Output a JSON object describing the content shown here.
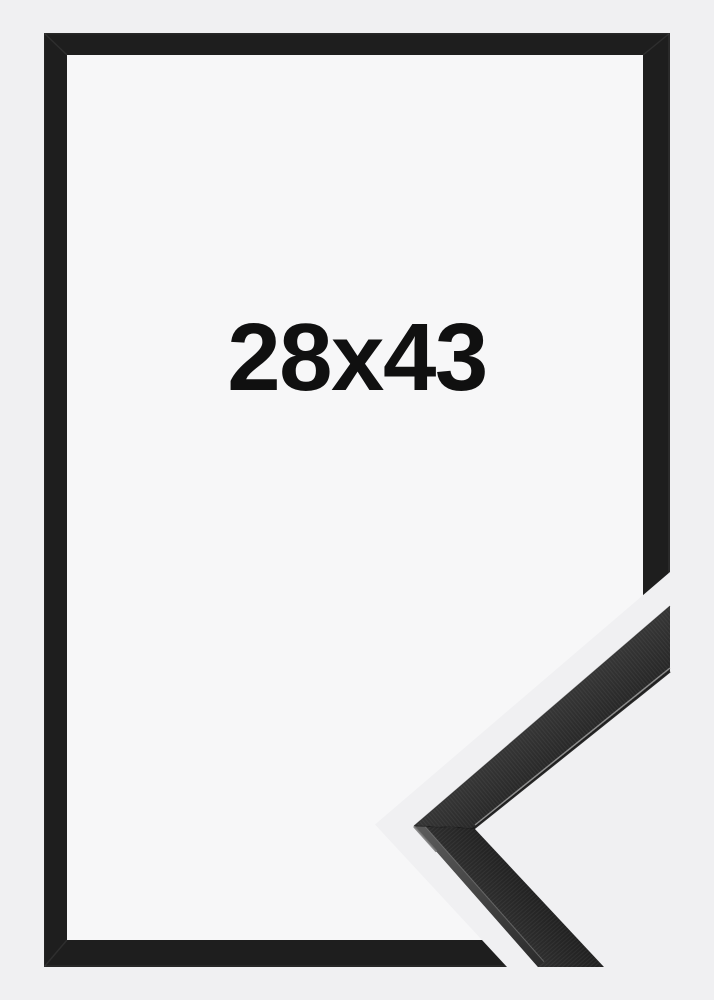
{
  "frame_preview": {
    "size_label": "28x43",
    "colors": {
      "background": "#f0f0f2",
      "interior": "#f7f7f8",
      "frame": "#1e1e1e",
      "label_text": "#101010",
      "sample_face_upper": "#363636",
      "sample_face_upper_dark": "#252525",
      "sample_face_lower": "#303030",
      "sample_face_lower_dark": "#212121",
      "sample_bevel_light": "#5c5c5c",
      "sample_bevel_dark": "#2c2c2c",
      "sample_edge_highlight": "#9a9a9a"
    }
  }
}
